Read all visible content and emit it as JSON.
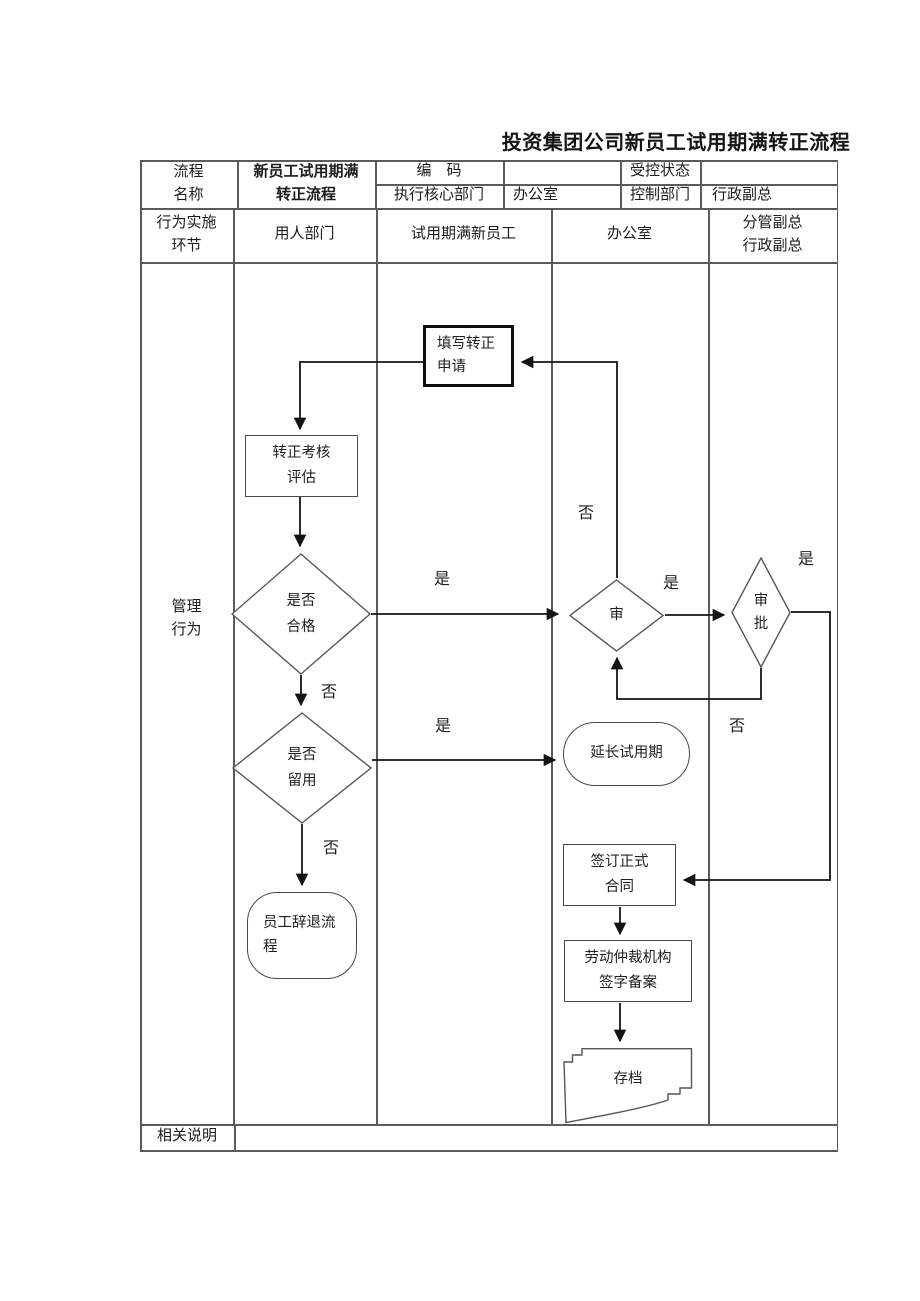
{
  "title": "投资集团公司新员工试用期满转正流程",
  "header": {
    "process_name_label": "流程\n名称",
    "process_name_value": "新员工试用期满\n转正流程",
    "code_label": "编　码",
    "exec_dept_label": "执行核心部门",
    "exec_dept_value": "办公室",
    "controlled_status_label": "受控状态",
    "control_dept_label": "控制部门",
    "control_dept_value": "行政副总"
  },
  "columns": {
    "stage_label": "行为实施\n环节",
    "hiring_dept": "用人部门",
    "new_employee": "试用期满新员工",
    "office": "办公室",
    "deputy_gm": "分管副总\n行政副总"
  },
  "row_labels": {
    "management": "管理\n行为",
    "notes": "相关说明"
  },
  "flowchart": {
    "apply": "填写转正\n申请",
    "evaluate": "转正考核\n评估",
    "qualified": "是否\n合格",
    "retain": "是否\n留用",
    "dismiss": "员工辞退流\n程",
    "review": "审",
    "approve": "审\n批",
    "extend": "延长试用期",
    "contract": "签订正式\n合同",
    "arbitration": "劳动仲裁机构\n签字备案",
    "archive": "存档",
    "labels": {
      "yes_qualified": "是",
      "no_qualified": "否",
      "yes_retain": "是",
      "no_retain": "否",
      "no_review": "否",
      "yes_review": "是",
      "yes_approve": "是",
      "no_approve": "否"
    }
  }
}
